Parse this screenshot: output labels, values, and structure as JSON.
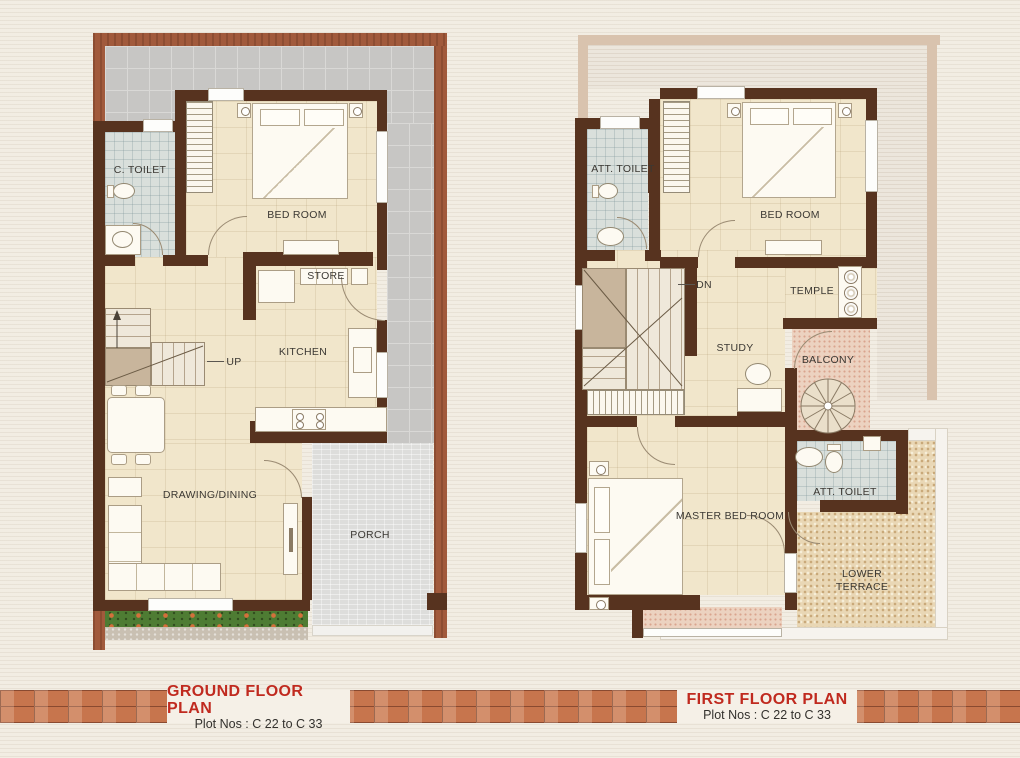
{
  "ground_floor": {
    "labels": {
      "c_toilet": "C. TOILET",
      "bed_room": "BED ROOM",
      "store": "STORE",
      "kitchen": "KITCHEN",
      "up": "UP",
      "drawing_dining": "DRAWING/DINING",
      "porch": "PORCH"
    },
    "footer": {
      "title": "GROUND FLOOR PLAN",
      "subtitle": "Plot Nos : C 22 to C 33"
    }
  },
  "first_floor": {
    "labels": {
      "att_toilet_top": "ATT. TOILET",
      "bed_room": "BED ROOM",
      "dn": "DN",
      "temple": "TEMPLE",
      "study": "STUDY",
      "balcony": "BALCONY",
      "att_toilet_side": "ATT. TOILET",
      "master_bed_room": "MASTER BED ROOM",
      "lower_terrace": "LOWER TERRACE"
    },
    "footer": {
      "title": "FIRST FLOOR PLAN",
      "subtitle": "Plot Nos : C 22 to C 33"
    }
  },
  "colors": {
    "page_background": "#f2ede3",
    "house_wall": "#57331f",
    "plot_boundary": "#a15a3c",
    "floor_cream": "#f1e6cb",
    "bath_tile": "#d9dfdb",
    "yard_tile": "#c7c6c4",
    "porch": "#dddddb",
    "balcony": "#ecd2c0",
    "lower_terrace": "#e9d7b5",
    "garden_green": "#4e7c33",
    "brick_band": "#c7754d",
    "footer_title_red": "#c02a1f",
    "label_text": "#3b3833"
  }
}
